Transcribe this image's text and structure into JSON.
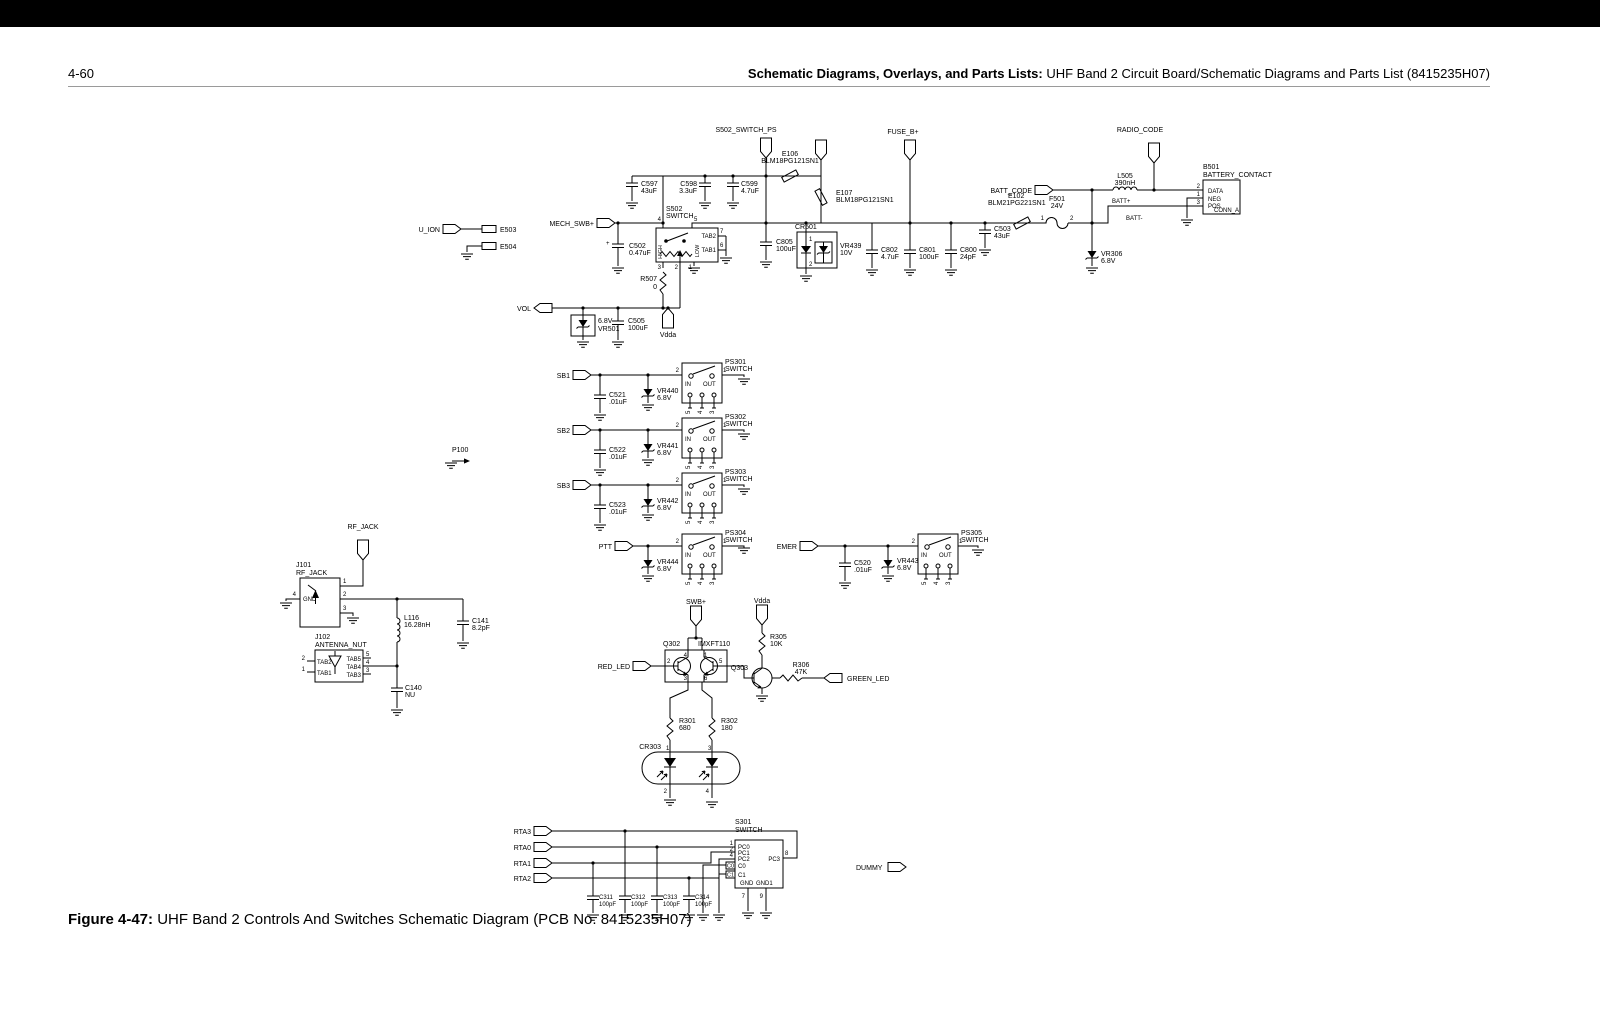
{
  "page": {
    "page_number": "4-60",
    "header": {
      "bold": "Schematic Diagrams, Overlays, and Parts Lists:",
      "rest": " UHF Band 2 Circuit Board/Schematic Diagrams and Parts List (8415235H07)"
    },
    "caption": {
      "bold": "Figure 4-47:",
      "rest": " UHF Band 2 Controls And Switches Schematic Diagram (PCB No. 8415235H07)"
    }
  },
  "colors": {
    "line": "#000000",
    "background": "#ffffff",
    "topbar": "#000000"
  },
  "pins": {
    "p1": "1",
    "p2": "2",
    "p3": "3",
    "p4": "4",
    "p5": "5",
    "p6": "6",
    "p7": "7",
    "p8": "8",
    "p9": "9"
  },
  "power": {
    "u_ion": "U_ION",
    "e503": "E503",
    "e504": "E504",
    "mech_swb": "MECH_SWB+",
    "c502": {
      "ref": "C502",
      "val": "0.47uF",
      "plus": "+"
    },
    "s502": {
      "ref": "S502",
      "val": "SWITCH",
      "tab2": "TAB2",
      "tab1": "TAB1",
      "high": "HIGH",
      "low": "LOW"
    },
    "r507": {
      "ref": "R507",
      "val": "0"
    },
    "vol": "VOL",
    "vdda": "Vdda",
    "vr501": {
      "ref": "VR501",
      "val": "6.8V"
    },
    "c505": {
      "ref": "C505",
      "val": "100uF"
    },
    "c597": {
      "ref": "C597",
      "val": "43uF"
    },
    "c598": {
      "ref": "C598",
      "val": "3.3uF"
    },
    "c599": {
      "ref": "C599",
      "val": "4.7uF"
    },
    "s502_switch_ps": "S502_SWITCH_PS",
    "e106": {
      "ref": "E106",
      "val": "BLM18PG121SN1"
    },
    "e107": {
      "ref": "E107",
      "val": "BLM18PG121SN1"
    },
    "c805": {
      "ref": "C805",
      "val": "100uF"
    },
    "cr501": {
      "ref": "CR501"
    },
    "vr439": {
      "ref": "VR439",
      "val": "10V"
    },
    "fuse_b": "FUSE_B+",
    "c802": {
      "ref": "C802",
      "val": "4.7uF"
    },
    "c801": {
      "ref": "C801",
      "val": "100uF"
    },
    "c800": {
      "ref": "C800",
      "val": "24pF"
    },
    "c503": {
      "ref": "C503",
      "val": "43uF"
    },
    "e102": {
      "ref": "E102",
      "val": "BLM21PG221SN1"
    },
    "f501": {
      "ref": "F501",
      "val": "24V"
    },
    "batt_code": "BATT_CODE",
    "l505": {
      "ref": "L505",
      "val": "390nH"
    },
    "radio_code": "RADIO_CODE",
    "b501": {
      "ref": "B501",
      "val": "BATTERY_CONTACT",
      "data": "DATA",
      "neg": "NEG",
      "pos": "POS",
      "conn": "CONN_A"
    },
    "batt_plus": "BATT+",
    "batt_minus": "BATT-",
    "vr306": {
      "ref": "VR306",
      "val": "6.8V"
    }
  },
  "switches": {
    "in": "IN",
    "out": "OUT",
    "sb1": "SB1",
    "sb2": "SB2",
    "sb3": "SB3",
    "ptt": "PTT",
    "emer": "EMER",
    "p100": "P100",
    "c521": {
      "ref": "C521",
      "val": ".01uF"
    },
    "c522": {
      "ref": "C522",
      "val": ".01uF"
    },
    "c523": {
      "ref": "C523",
      "val": ".01uF"
    },
    "c520": {
      "ref": "C520",
      "val": ".01uF"
    },
    "vr440": {
      "ref": "VR440",
      "val": "6.8V"
    },
    "vr441": {
      "ref": "VR441",
      "val": "6.8V"
    },
    "vr442": {
      "ref": "VR442",
      "val": "6.8V"
    },
    "vr443": {
      "ref": "VR443",
      "val": "6.8V"
    },
    "vr444": {
      "ref": "VR444",
      "val": "6.8V"
    },
    "ps301": {
      "ref": "PS301",
      "val": "SWITCH"
    },
    "ps302": {
      "ref": "PS302",
      "val": "SWITCH"
    },
    "ps303": {
      "ref": "PS303",
      "val": "SWITCH"
    },
    "ps304": {
      "ref": "PS304",
      "val": "SWITCH"
    },
    "ps305": {
      "ref": "PS305",
      "val": "SWITCH"
    }
  },
  "rf": {
    "rf_jack": "RF_JACK",
    "j101": {
      "ref": "J101",
      "val": "RF_JACK",
      "gnd": "GND"
    },
    "l116": {
      "ref": "L116",
      "val": "16.28nH"
    },
    "c141": {
      "ref": "C141",
      "val": "8.2pF"
    },
    "j102": {
      "ref": "J102",
      "val": "ANTENNA_NUT",
      "tab1": "TAB1",
      "tab2": "TAB2",
      "tab3": "TAB3",
      "tab4": "TAB4",
      "tab5": "TAB5"
    },
    "c140": {
      "ref": "C140",
      "val": "NU"
    }
  },
  "led": {
    "swb": "SWB+",
    "vdda": "Vdda",
    "red_led": "RED_LED",
    "green_led": "GREEN_LED",
    "q302": {
      "ref": "Q302",
      "val": "IMXFT110"
    },
    "q303": {
      "ref": "Q303"
    },
    "r305": {
      "ref": "R305",
      "val": "10K"
    },
    "r306": {
      "ref": "R306",
      "val": "47K"
    },
    "r301": {
      "ref": "R301",
      "val": "680"
    },
    "r302": {
      "ref": "R302",
      "val": "180"
    },
    "cr303": {
      "ref": "CR303"
    }
  },
  "keypad": {
    "rta3": "RTA3",
    "rta0": "RTA0",
    "rta1": "RTA1",
    "rta2": "RTA2",
    "dummy": "DUMMY",
    "c311": {
      "ref": "C311",
      "val": "100pF"
    },
    "c312": {
      "ref": "C312",
      "val": "100pF"
    },
    "c313": {
      "ref": "C313",
      "val": "100pF"
    },
    "c314": {
      "ref": "C314",
      "val": "100pF"
    },
    "s301": {
      "ref": "S301",
      "val": "SWITCH",
      "pc0": "PC0",
      "pc1": "PC1",
      "pc2": "PC2",
      "pc3": "PC3",
      "c0": "C0",
      "c1": "C1",
      "gnd": "GND",
      "gnd1": "GND1"
    }
  }
}
